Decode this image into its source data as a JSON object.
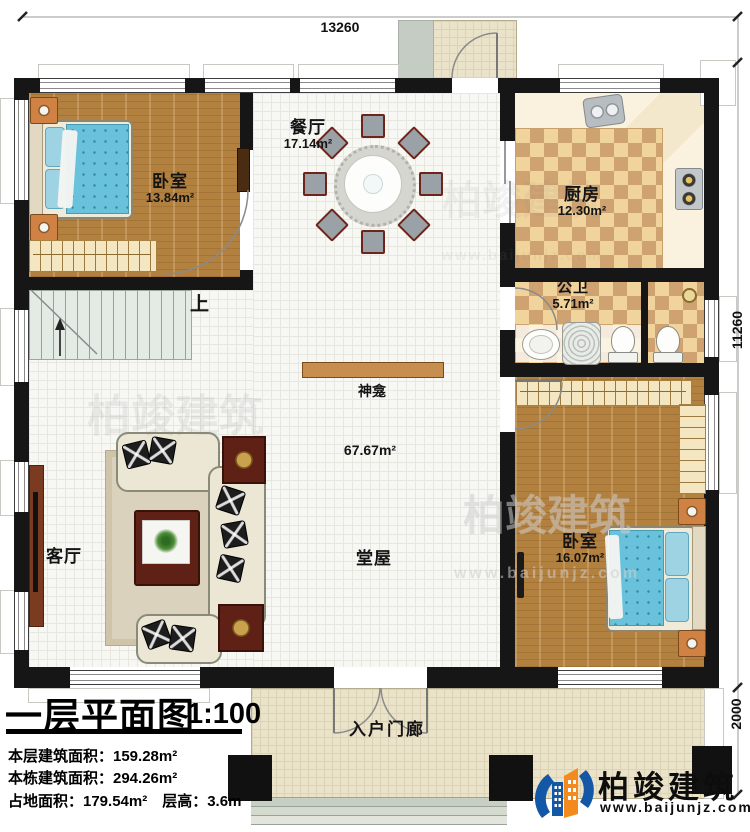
{
  "plan": {
    "dims": {
      "top": "13260",
      "right": "11260",
      "porch": "2000"
    },
    "rooms": {
      "bedroom_tl": {
        "name": "卧室",
        "area": "13.84m²"
      },
      "dining": {
        "name": "餐厅",
        "area": "17.14m²"
      },
      "kitchen": {
        "name": "厨房",
        "area": "12.30m²"
      },
      "bath": {
        "name": "公卫",
        "area": "5.71m²"
      },
      "bedroom_r": {
        "name": "卧室",
        "area": "16.07m²"
      },
      "living": {
        "name": "客厅"
      },
      "hall": {
        "name": "堂屋",
        "area": "67.67m²"
      },
      "porch": {
        "name": "入户门廊"
      }
    },
    "notes": {
      "stairs_up": "上",
      "shrine": "神龛"
    }
  },
  "title_block": {
    "title": "一层平面图",
    "scale": "1:100",
    "stat1": "本层建筑面积：159.28m²",
    "stat2": "本栋建筑面积：294.26m²",
    "stat3": "占地面积：179.54m²　层高：3.6m"
  },
  "branding": {
    "name": "柏竣建筑",
    "website": "www.baijunjz.com"
  },
  "colors": {
    "wall": "#161616",
    "brand_blue": "#1358a6",
    "brand_orange": "#f28a1e",
    "wood": "#b3813f",
    "checker_dark": "#cfa271",
    "checker_light": "#f0d49c"
  }
}
